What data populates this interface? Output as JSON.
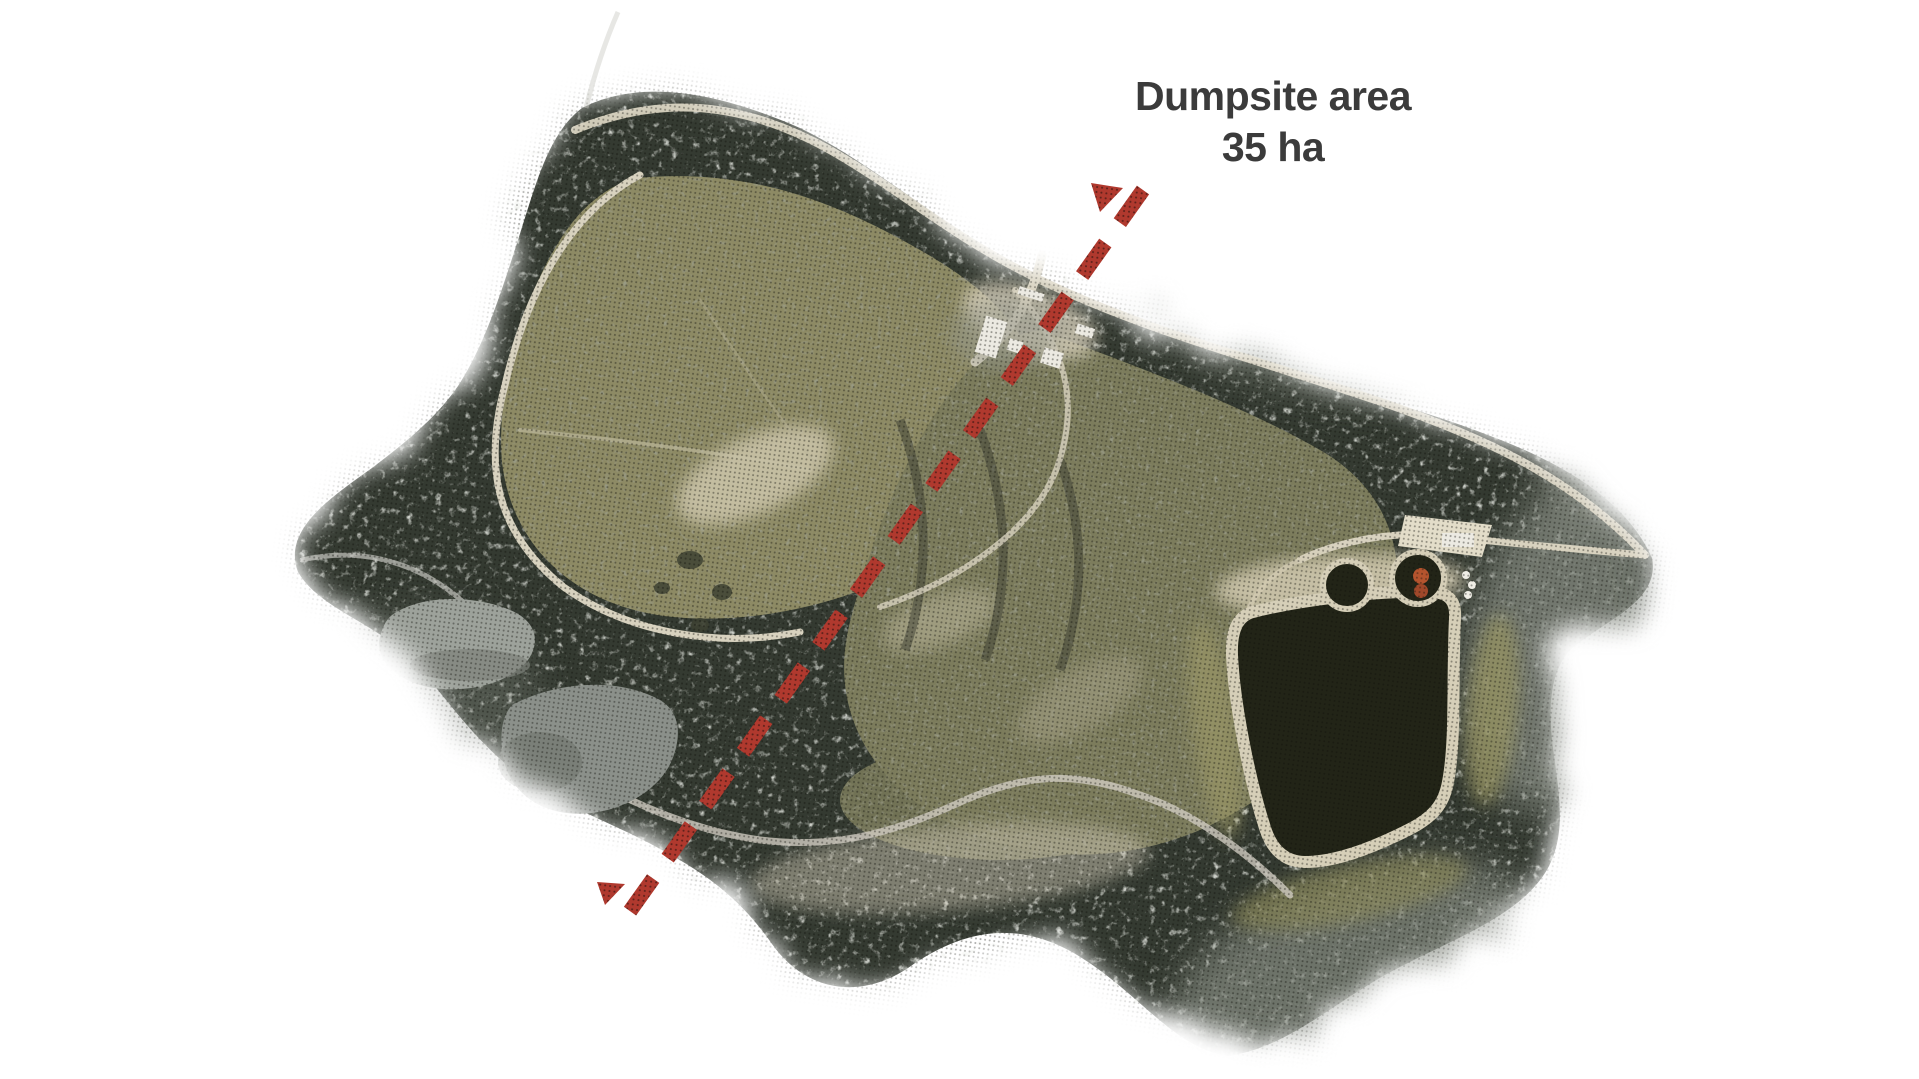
{
  "annotation": {
    "title_line1": "Dumpsite area",
    "title_line2": "35 ha",
    "text_color": "#3b3b3b",
    "transect_color": "#b0392e",
    "transect_dot_color": "#5e201a"
  },
  "map": {
    "colors": {
      "forest": "#343a31",
      "forest_light": "#868b81",
      "field": "#8d8a64",
      "field_dark": "#7c7c5c",
      "road": "#d8d2bf",
      "sand": "#d3cbb1",
      "pond_dark": "#222417",
      "pond_rim": "#d6cfb8",
      "pond_gray_upper": "#9da29b",
      "pond_gray_lower": "#8b908a",
      "building": "#eceae2",
      "tank": "#b4542e"
    }
  }
}
